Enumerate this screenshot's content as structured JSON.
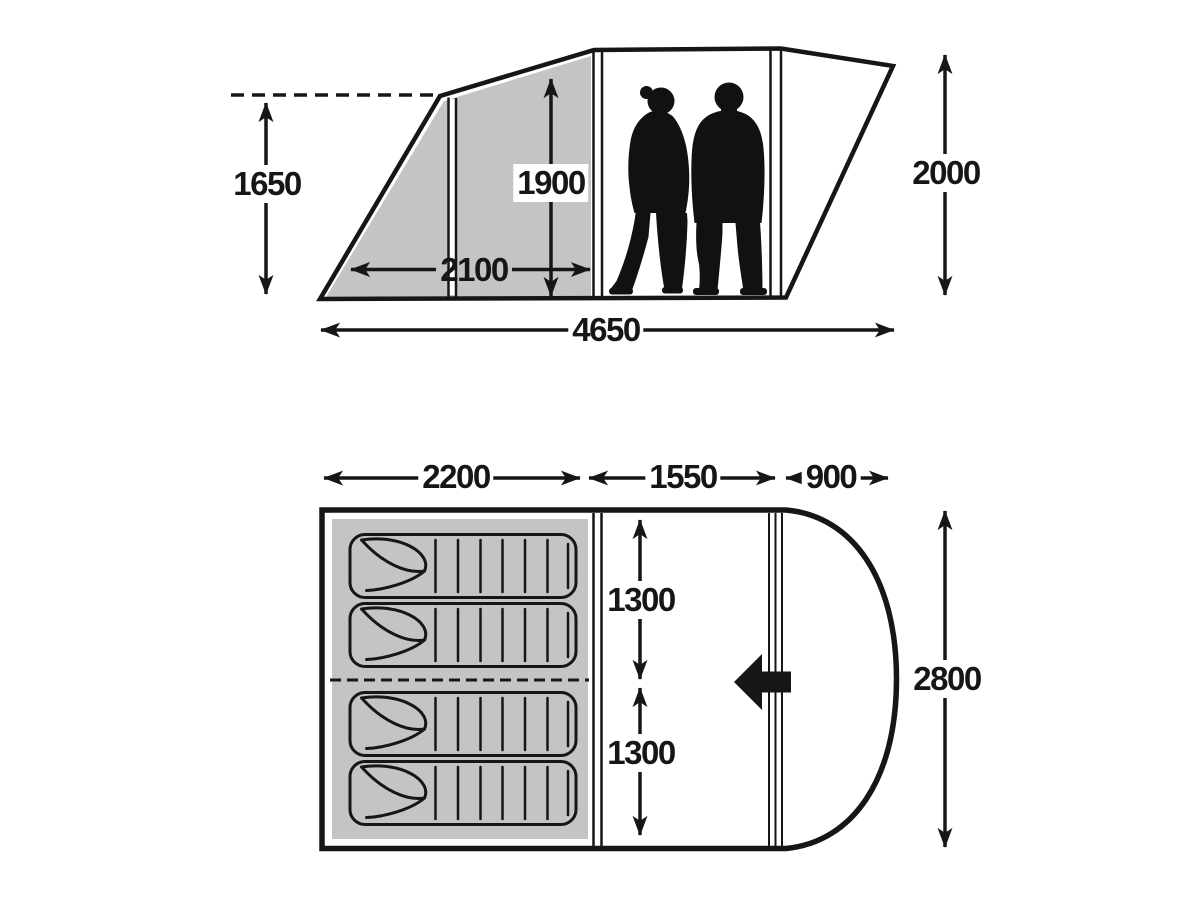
{
  "colors": {
    "line": "#161616",
    "shade": "#c4c4c4",
    "background": "#ffffff"
  },
  "side_view": {
    "title": "tent-side-elevation",
    "dimensions": {
      "awning_height": "1650",
      "inner_height": "1900",
      "bedroom_depth": "2100",
      "total_length": "4650",
      "max_height": "2000"
    },
    "figures": [
      "woman-silhouette",
      "man-silhouette"
    ]
  },
  "floor_plan": {
    "title": "tent-floor-plan",
    "dimensions": {
      "bedroom_length": "2200",
      "living_area_length": "1550",
      "canopy_depth": "900",
      "bedroom_half_width_upper": "1300",
      "bedroom_half_width_lower": "1300",
      "total_width": "2800"
    },
    "sleeping_bags": 4,
    "icons": [
      "entrance-arrow"
    ]
  }
}
